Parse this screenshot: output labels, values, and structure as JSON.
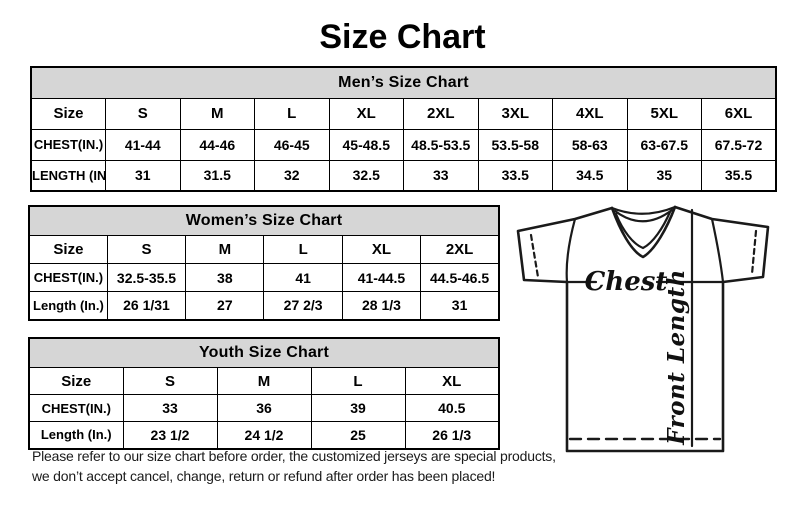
{
  "page": {
    "title": "Size Chart"
  },
  "colors": {
    "background": "#ffffff",
    "table_header_bg": "#d6d6d6",
    "border": "#000000",
    "text": "#000000"
  },
  "tables": {
    "mens": {
      "title": "Men’s Size Chart",
      "header_row": [
        "Size",
        "S",
        "M",
        "L",
        "XL",
        "2XL",
        "3XL",
        "4XL",
        "5XL",
        "6XL"
      ],
      "rows": [
        [
          "CHEST(IN.)",
          "41-44",
          "44-46",
          "46-45",
          "45-48.5",
          "48.5-53.5",
          "53.5-58",
          "58-63",
          "63-67.5",
          "67.5-72"
        ],
        [
          "LENGTH (IN.)",
          "31",
          "31.5",
          "32",
          "32.5",
          "33",
          "33.5",
          "34.5",
          "35",
          "35.5"
        ]
      ]
    },
    "womens": {
      "title": "Women’s Size Chart",
      "header_row": [
        "Size",
        "S",
        "M",
        "L",
        "XL",
        "2XL"
      ],
      "rows": [
        [
          "CHEST(IN.)",
          "32.5-35.5",
          "38",
          "41",
          "41-44.5",
          "44.5-46.5"
        ],
        [
          "Length (In.)",
          "26 1/31",
          "27",
          "27 2/3",
          "28 1/3",
          "31"
        ]
      ]
    },
    "youth": {
      "title": "Youth Size Chart",
      "header_row": [
        "Size",
        "S",
        "M",
        "L",
        "XL"
      ],
      "rows": [
        [
          "CHEST(IN.)",
          "33",
          "36",
          "39",
          "40.5"
        ],
        [
          "Length (In.)",
          "23 1/2",
          "24 1/2",
          "25",
          "26 1/3"
        ]
      ]
    }
  },
  "diagram": {
    "chest_label": "Chest",
    "front_length_label": "Front Length"
  },
  "disclaimer": {
    "line1": "Please refer to our size chart before order, the customized jerseys are special products,",
    "line2": "we don’t accept cancel, change, return or refund after order has been placed!"
  }
}
